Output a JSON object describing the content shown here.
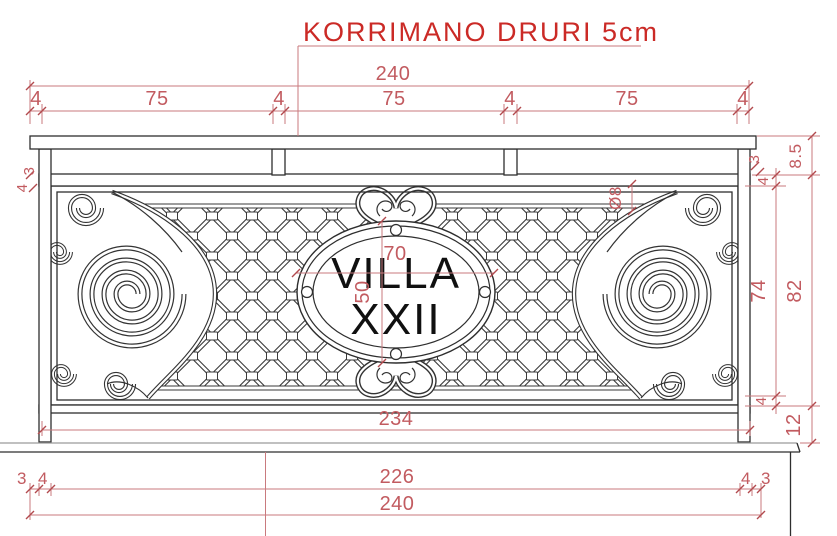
{
  "title": {
    "text": "KORRIMANO DRURI 5cm"
  },
  "medallion": {
    "line1": "VILLA",
    "line2": "XXII"
  },
  "dimensions": {
    "top_total": "240",
    "top_segments": [
      "4",
      "75",
      "4",
      "75",
      "4",
      "75",
      "4"
    ],
    "oval_width": "70",
    "oval_height": "50",
    "bar_diameter": "Ø8",
    "left_step": "3",
    "left_gap": "4",
    "right_step": "3",
    "right_gap_top": "4",
    "handrail_height": "8.5",
    "panel_inner_height": "74",
    "panel_outer_height": "82",
    "right_gap_bottom": "4",
    "base_height": "12",
    "frame_width": "234",
    "bottom_left_step": "3",
    "bottom_left_gap": "4",
    "bottom_inner_width": "226",
    "bottom_right_gap": "4",
    "bottom_right_step": "3",
    "bottom_total": "240"
  },
  "colors": {
    "dimension_red": "#c25b60",
    "title_red": "#cb2a26",
    "line_black": "#2e2e2e"
  }
}
